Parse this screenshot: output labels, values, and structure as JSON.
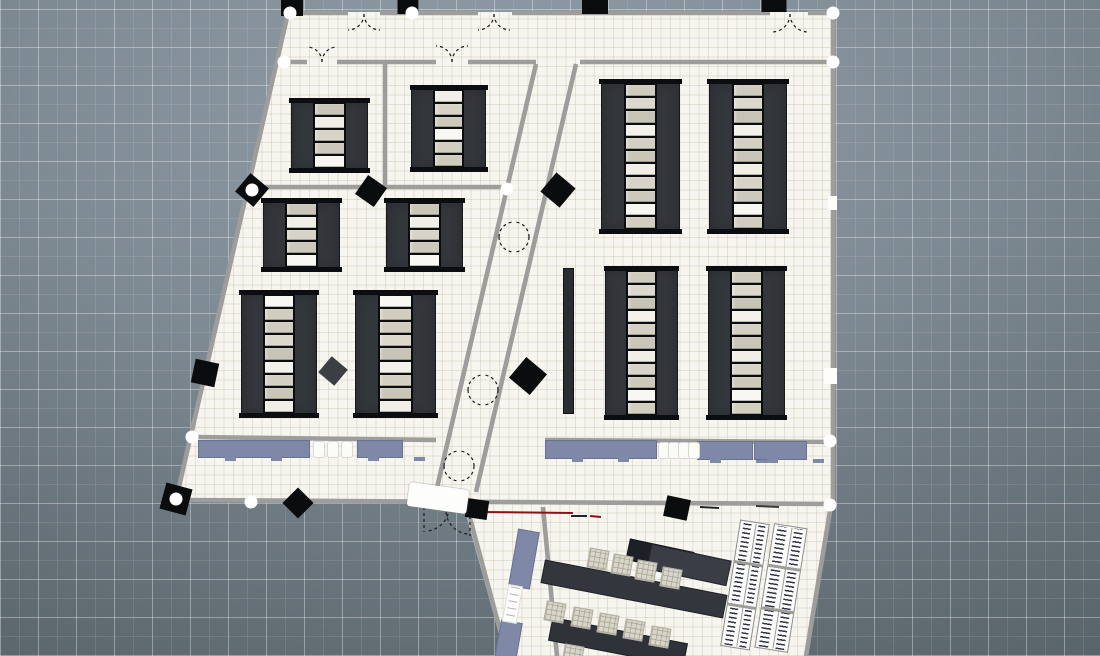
{
  "app": {
    "name": "floor-plan-top-view",
    "visible_text": []
  },
  "canvas": {
    "width": 1100,
    "height": 656,
    "background": {
      "gradient": [
        "#919da7",
        "#7e8b94",
        "#616c73",
        "#49535a"
      ],
      "grid_major_px": 38,
      "grid_minor_px": 19,
      "grid_major_color": "rgba(255,255,255,0.28)",
      "grid_minor_color": "rgba(255,255,255,0.10)"
    }
  },
  "colors": {
    "wall": "#9d9d9b",
    "floor": "#f6f5ef",
    "column": "#0b0c0e",
    "column_gray": "#3b3e42",
    "rack_body": "#33363b",
    "rack_frame": "#0c0d10",
    "desk": "#7f88a7",
    "counter": "#8088a8",
    "table_dark": "#1d2026",
    "table_mid": "#3a3d46",
    "table_std": "#33363d",
    "chair_light": "#d8d5c9",
    "book_mark": "#32344a",
    "accent_red": "#8c1219"
  },
  "plan": {
    "floors": [
      {
        "id": "main-building-floor",
        "left": 176,
        "top": 12,
        "width": 657,
        "height": 492,
        "clip": "polygon(112px 0px, 657px 0px, 657px 492px, 0px 488px)"
      },
      {
        "id": "annex-floor",
        "left": 455,
        "top": 502,
        "width": 377,
        "height": 154,
        "clip": "polygon(8px 1px, 376px 1px, 351px 154px, 50px 154px)"
      }
    ],
    "walls": [
      [
        288,
        13,
        348,
        13
      ],
      [
        380,
        13,
        478,
        13
      ],
      [
        512,
        13,
        770,
        13
      ],
      [
        808,
        13,
        833,
        13
      ],
      [
        833,
        13,
        833,
        504
      ],
      [
        176,
        500,
        833,
        504
      ],
      [
        288,
        13,
        176,
        500
      ],
      [
        284,
        62,
        307,
        62
      ],
      [
        337,
        62,
        436,
        62
      ],
      [
        468,
        62,
        536,
        62
      ],
      [
        580,
        62,
        833,
        62
      ],
      [
        536,
        64,
        436,
        492
      ],
      [
        576,
        64,
        476,
        492
      ],
      [
        385,
        63,
        385,
        187
      ],
      [
        252,
        187,
        505,
        187
      ],
      [
        193,
        437,
        436,
        440
      ],
      [
        545,
        440,
        833,
        442
      ],
      [
        467,
        507,
        507,
        656
      ],
      [
        831,
        505,
        806,
        656
      ],
      [
        543,
        507,
        557,
        656
      ]
    ],
    "junction_dots": [
      [
        290,
        13
      ],
      [
        412,
        13
      ],
      [
        833,
        13
      ],
      [
        284,
        62
      ],
      [
        833,
        62
      ],
      [
        252,
        190
      ],
      [
        507,
        189
      ],
      [
        192,
        437
      ],
      [
        830,
        441
      ],
      [
        176,
        499
      ],
      [
        251,
        502
      ],
      [
        830,
        505
      ]
    ],
    "columns": [
      [
        292,
        8,
        22,
        16,
        0,
        ""
      ],
      [
        408,
        7,
        21,
        14,
        0,
        ""
      ],
      [
        595,
        7,
        26,
        14,
        0,
        ""
      ],
      [
        774,
        6,
        25,
        12,
        0,
        ""
      ],
      [
        252,
        190,
        24,
        24,
        40,
        ""
      ],
      [
        205,
        373,
        24,
        24,
        12,
        ""
      ],
      [
        371,
        191,
        23,
        23,
        35,
        ""
      ],
      [
        558,
        190,
        25,
        25,
        40,
        ""
      ],
      [
        333,
        371,
        21,
        21,
        40,
        "#3b3e42"
      ],
      [
        528,
        376,
        27,
        27,
        40,
        ""
      ],
      [
        298,
        503,
        22,
        22,
        45,
        ""
      ],
      [
        477,
        509,
        22,
        19,
        8,
        ""
      ],
      [
        677,
        508,
        24,
        21,
        12,
        ""
      ],
      [
        176,
        499,
        27,
        27,
        15,
        ""
      ]
    ],
    "racks": [
      [
        291,
        100,
        77,
        71,
        5
      ],
      [
        411,
        87,
        75,
        83,
        6
      ],
      [
        263,
        200,
        77,
        70,
        5
      ],
      [
        386,
        200,
        77,
        70,
        5
      ],
      [
        241,
        292,
        76,
        124,
        9
      ],
      [
        355,
        292,
        81,
        124,
        9
      ],
      [
        601,
        81,
        79,
        151,
        11
      ],
      [
        709,
        81,
        78,
        151,
        11
      ],
      [
        605,
        268,
        73,
        150,
        11
      ],
      [
        708,
        268,
        77,
        150,
        11
      ]
    ],
    "rack_shelf_palette": [
      "#cfcbbd",
      "#dcd8cc",
      "#c7c3b5",
      "#f3f1ea",
      "#d3cfc2",
      "#c9c5b7",
      "#f0eee6",
      "#d7d3c6",
      "#ccc8ba",
      "#f8f7f2",
      "#d1cdbf"
    ],
    "thin_panel": [
      563,
      268,
      11,
      146
    ],
    "desks": [
      [
        198,
        440,
        112,
        18
      ],
      [
        357,
        440,
        46,
        18
      ],
      [
        545,
        440,
        112,
        19
      ],
      [
        697,
        441,
        56,
        19
      ],
      [
        754,
        441,
        53,
        19
      ]
    ],
    "desk_chairs": [
      [
        313,
        441
      ],
      [
        327,
        441
      ],
      [
        341,
        441
      ],
      [
        658,
        442
      ],
      [
        668,
        442
      ],
      [
        678,
        442
      ],
      [
        688,
        442
      ]
    ],
    "door_leaf": [
      408,
      486,
      60,
      24,
      8
    ],
    "window_tabs": [
      [
        828,
        196,
        9,
        14
      ],
      [
        824,
        368,
        13,
        16
      ]
    ],
    "door_arcs": [
      "M364,14 A16,16 0 0 1 348,30",
      "M364,14 A16,16 0 0 0 380,30",
      "M494,14 A16,16 0 0 1 478,30",
      "M494,14 A16,16 0 0 0 510,30",
      "M790,14 A18,18 0 0 1 772,32",
      "M790,14 A18,18 0 0 0 808,32",
      "M322,62 A15,15 0 0 0 307,47",
      "M322,62 A15,15 0 0 1 337,47",
      "M452,62 A16,16 0 0 0 436,46",
      "M452,62 A16,16 0 0 1 468,46",
      "M499,237 A15,15 0 0 1 514,222",
      "M529,237 A15,15 0 0 0 514,222",
      "M499,237 A15,15 0 0 0 514,252",
      "M529,237 A15,15 0 0 1 514,252",
      "M468,390 A15,15 0 0 1 483,375",
      "M498,390 A15,15 0 0 0 483,375",
      "M468,390 A15,15 0 0 0 483,405",
      "M498,390 A15,15 0 0 1 483,405",
      "M444,466 A15,15 0 0 1 459,451",
      "M474,466 A15,15 0 0 0 459,451",
      "M444,466 A15,15 0 0 0 459,481",
      "M474,466 A15,15 0 0 1 459,481",
      "M449,508 A24,24 0 0 1 427,531",
      "M446,512 A24,24 0 0 0 468,534",
      "M424,507 L424,532",
      "M470,510 L470,536"
    ],
    "floor_marks": [
      [
        455,
        511,
        477,
        511,
        "#17181e",
        3
      ],
      [
        481,
        512,
        573,
        513,
        "#8c1219",
        2
      ],
      [
        571,
        516,
        587,
        516,
        "#20222c",
        2
      ],
      [
        590,
        516,
        601,
        517,
        "#8c1219",
        2
      ],
      [
        700,
        507,
        719,
        508,
        "#23252e",
        2
      ],
      [
        756,
        506,
        779,
        507,
        "#3a3a3a",
        2
      ]
    ],
    "annex": {
      "tables": [
        [
          627,
          545,
          66,
          22,
          12,
          "#1d2026"
        ],
        [
          648,
          552,
          82,
          26,
          12,
          "#3a3d46"
        ],
        [
          541,
          577,
          186,
          24,
          11,
          "#33363d"
        ],
        [
          549,
          630,
          138,
          24,
          11,
          "#2f3238"
        ]
      ],
      "chairs": [
        [
          588,
          549
        ],
        [
          612,
          555
        ],
        [
          636,
          561
        ],
        [
          661,
          568
        ],
        [
          545,
          602
        ],
        [
          572,
          608
        ],
        [
          598,
          614
        ],
        [
          624,
          620
        ],
        [
          650,
          627
        ],
        [
          563,
          645
        ]
      ],
      "counters": [
        [
          513,
          530,
          22,
          58,
          10
        ],
        [
          497,
          621,
          22,
          46,
          10
        ]
      ],
      "sign": [
        505,
        585,
        15,
        38,
        10
      ],
      "bookshelves": [
        [
          730,
          521,
          30,
          128,
          9
        ],
        [
          764,
          525,
          34,
          126,
          9
        ]
      ]
    }
  }
}
